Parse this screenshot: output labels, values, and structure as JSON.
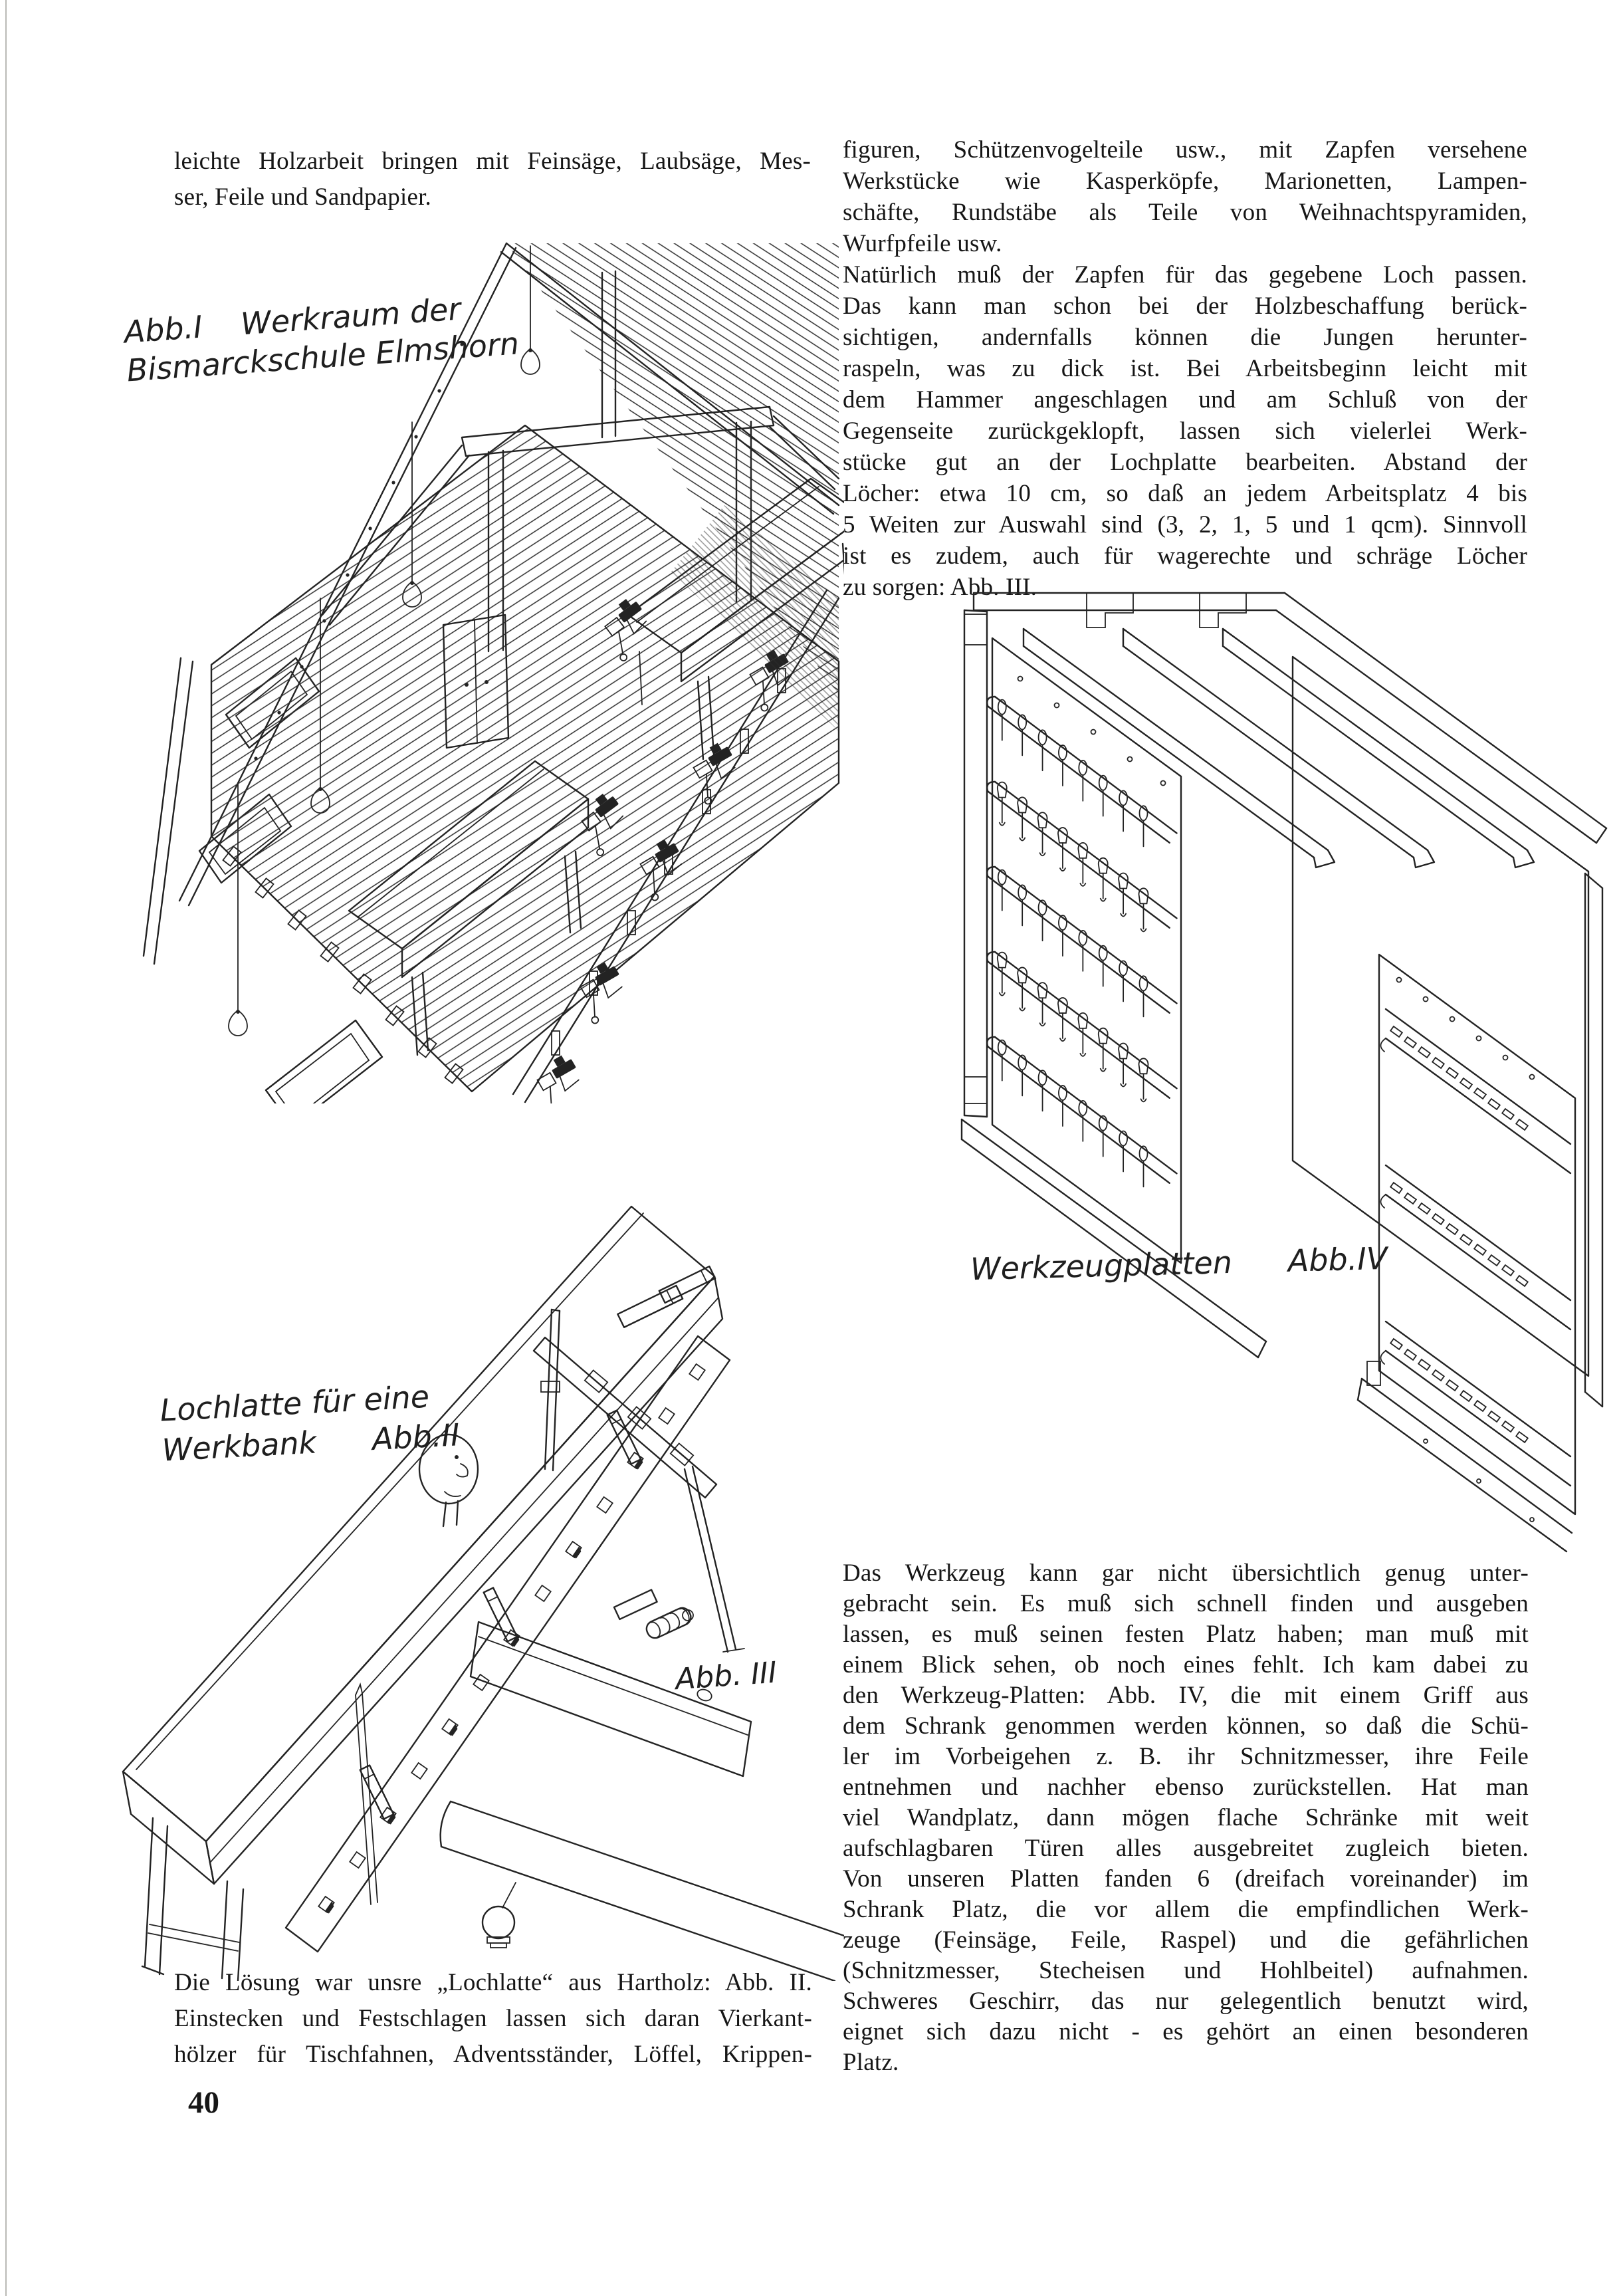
{
  "page": {
    "number": "40",
    "paper_color": "#ffffff",
    "ink_color": "#1b1b1b",
    "language": "de"
  },
  "text": {
    "left_top_lines": [
      "leichte Holzarbeit bringen mit Feinsäge, Laubsäge, Mes-",
      "ser, Feile und Sandpapier."
    ],
    "right_top_lines": [
      "figuren, Schützenvogelteile usw., mit Zapfen versehene",
      "Werkstücke wie Kasperköpfe, Marionetten, Lampen-",
      "schäfte, Rundstäbe als Teile von Weihnachtspyramiden,",
      "Wurfpfeile usw.",
      "Natürlich muß der Zapfen für das gegebene Loch passen.",
      "Das kann man schon bei der Holzbeschaffung berück-",
      "sichtigen, andernfalls können die Jungen herunter-",
      "raspeln, was zu dick ist. Bei Arbeitsbeginn leicht mit",
      "dem Hammer angeschlagen und am Schluß von der",
      "Gegenseite zurückgeklopft, lassen sich vielerlei Werk-",
      "stücke gut an der Lochplatte bearbeiten. Abstand der",
      "Löcher: etwa 10 cm, so daß an jedem Arbeitsplatz 4 bis",
      "5 Weiten zur Auswahl sind (3, 2, 1, 5 und 1 qcm). Sinnvoll",
      "ist es zudem, auch für wagerechte und schräge Löcher",
      "zu sorgen: Abb. III."
    ],
    "left_caption_lines": [
      "Die Lösung war unsre „Lochlatte“ aus Hartholz: Abb. II.",
      "Einstecken und Festschlagen lassen sich daran Vierkant-",
      "hölzer für Tischfahnen, Adventsständer, Löffel, Krippen-"
    ],
    "right_bottom_lines": [
      "Das Werkzeug kann gar nicht übersichtlich genug unter-",
      "gebracht sein. Es muß sich schnell finden und ausgeben",
      "lassen, es muß seinen festen Platz haben; man muß mit",
      "einem Blick sehen, ob noch eines fehlt. Ich kam dabei zu",
      "den Werkzeug-Platten: Abb. IV, die mit einem Griff aus",
      "dem Schrank genommen werden können, so daß die Schü-",
      "ler im Vorbeigehen z. B. ihr Schnitzmesser, ihre Feile",
      "entnehmen und nachher ebenso zurückstellen. Hat man",
      "viel Wandplatz, dann mögen flache Schränke mit weit",
      "aufschlagbaren Türen alles ausgebreitet zugleich bieten.",
      "Von unseren Platten fanden 6 (dreifach voreinander) im",
      "Schrank Platz, die vor allem die empfindlichen Werk-",
      "zeuge (Feinsäge, Feile, Raspel) und die gefährlichen",
      "(Schnitzmesser, Stecheisen und Hohlbeitel) aufnahmen.",
      "Schweres Geschirr, das nur gelegentlich benutzt wird,",
      "eignet sich dazu nicht - es gehört an einen besonderen",
      "Platz."
    ]
  },
  "figures": {
    "fig1": {
      "ref": "Abb.I",
      "title_line1": "Werkraum der",
      "title_line2": "Bismarckschule Elmshorn"
    },
    "fig2": {
      "title_line1": "Lochlatte für eine",
      "title_line2": "Werkbank",
      "ref": "Abb.II"
    },
    "fig3": {
      "ref": "Abb. III"
    },
    "fig4": {
      "title": "Werkzeugplatten",
      "ref": "Abb.IV"
    }
  }
}
